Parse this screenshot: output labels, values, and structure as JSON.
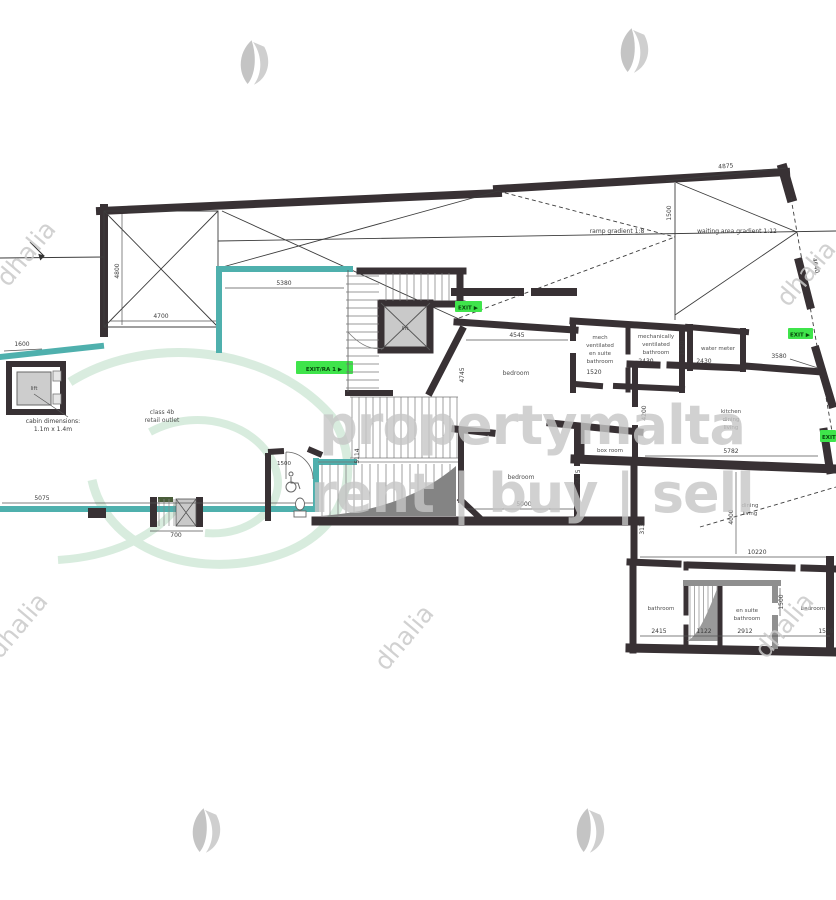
{
  "watermark": {
    "brand": "propertymalta",
    "tagline": "rent | buy | sell",
    "agency": "dhalia"
  },
  "annotations": {
    "ramp_gradient": "ramp gradient 1:8",
    "waiting_gradient": "waiting area gradient 1:12",
    "cabin_l1": "cabin dimensions:",
    "cabin_l2": "1.1m x 1.4m",
    "class4b_l1": "class 4b",
    "class4b_l2": "retail outlet",
    "lift": "lift"
  },
  "rooms": {
    "bedroom_top": "bedroom",
    "mech1": "mech",
    "mech2": "ventilated",
    "mech3": "en suite",
    "mech4": "bathroom",
    "mb1": "mechanically",
    "mb2": "ventilated",
    "mb3": "bathroom",
    "water_meter": "water meter",
    "kit1": "kitchen",
    "kit2": "dining",
    "kit3": "living",
    "bedroom_mid": "bedroom",
    "box_room": "box room",
    "din1": "dining",
    "din2": "living",
    "bathroom_br": "bathroom",
    "ens1": "en suite",
    "ens2": "bathroom",
    "bedroom_br": "bedroom"
  },
  "exits": {
    "exit_top": "EXIT ▶",
    "exit_right": "EXIT ▶",
    "exit_retail": "EXIT/RA 1 ▶",
    "exit_corner": "EXIT ▶"
  },
  "dims": {
    "top_width": "4875",
    "ramp_height": "4800",
    "ramp_width": "4700",
    "retail_top": "5380",
    "cabin_w": "1600",
    "retail_bottom": "5075",
    "shaft_w": "700",
    "wc_w": "1500",
    "strip_h": "1500",
    "bedroom_top_w": "4545",
    "bedroom_top_h": "4745",
    "ensuite_w": "1520",
    "bath_w": "2430",
    "meter_w": "2430",
    "bath_h": "1520",
    "right_wall": "3580",
    "right_slant": "4640",
    "kitchen_w": "5782",
    "kitchen_h": "4200",
    "bedroom_mid_w": "5000",
    "bedroom_mid_h": "2475",
    "stair_h": "5114",
    "dining_w2": "3135",
    "bottom_w": "10220",
    "dining_h": "4000",
    "bath_br_w": "2415",
    "shaft_br_w": "1122",
    "ensuite_br_w": "2912",
    "ensuite_br_h": "1500",
    "bedroom_br_w": "1580"
  }
}
